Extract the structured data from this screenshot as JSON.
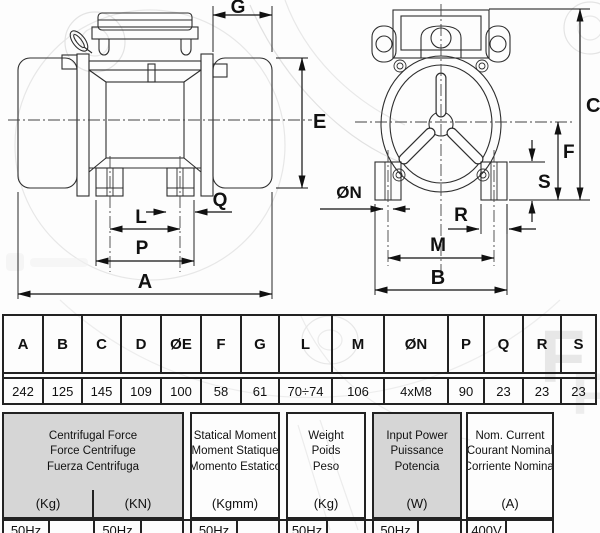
{
  "drawings": {
    "side_view": {
      "labels": {
        "G": "G",
        "E": "E",
        "Q": "Q",
        "L": "L",
        "P": "P",
        "A": "A"
      }
    },
    "front_view": {
      "labels": {
        "C": "C",
        "F": "F",
        "S": "S",
        "N": "ØN",
        "R": "R",
        "M": "M",
        "B": "B"
      }
    }
  },
  "dim_table": {
    "headers": [
      "A",
      "B",
      "C",
      "D",
      "ØE",
      "F",
      "G",
      "L",
      "M",
      "ØN",
      "P",
      "Q",
      "R",
      "S"
    ],
    "values": [
      "242",
      "125",
      "145",
      "109",
      "100",
      "58",
      "61",
      "70÷74",
      "106",
      "4xM8",
      "90",
      "23",
      "23",
      "23"
    ]
  },
  "spec_table": {
    "groups": [
      {
        "lines": [
          "Centrifugal Force",
          "Force Centrifuge",
          "Fuerza Centrifuga"
        ],
        "units": [
          "(Kg)",
          "(KN)"
        ],
        "row": [
          "50Hz",
          "",
          "50Hz",
          ""
        ]
      },
      {
        "lines": [
          "Statical Moment",
          "Moment Statique",
          "Momento Estatico"
        ],
        "units": [
          "(Kgmm)"
        ],
        "row": [
          "50Hz",
          ""
        ]
      },
      {
        "lines": [
          "Weight",
          "Poids",
          "Peso"
        ],
        "units": [
          "(Kg)"
        ],
        "row": [
          "50Hz",
          ""
        ]
      },
      {
        "lines": [
          "Input Power",
          "Puissance",
          "Potencia"
        ],
        "units": [
          "(W)"
        ],
        "row": [
          "50Hz",
          ""
        ]
      },
      {
        "lines": [
          "Nom. Current",
          "Courant Nominal",
          "Corriente Nominal"
        ],
        "units": [
          "(A)"
        ],
        "row": [
          "400V",
          ""
        ]
      }
    ]
  },
  "colors": {
    "header_gray": "#d6d6d6",
    "table_border": "#222222",
    "line_art": "#2e2e2e"
  }
}
